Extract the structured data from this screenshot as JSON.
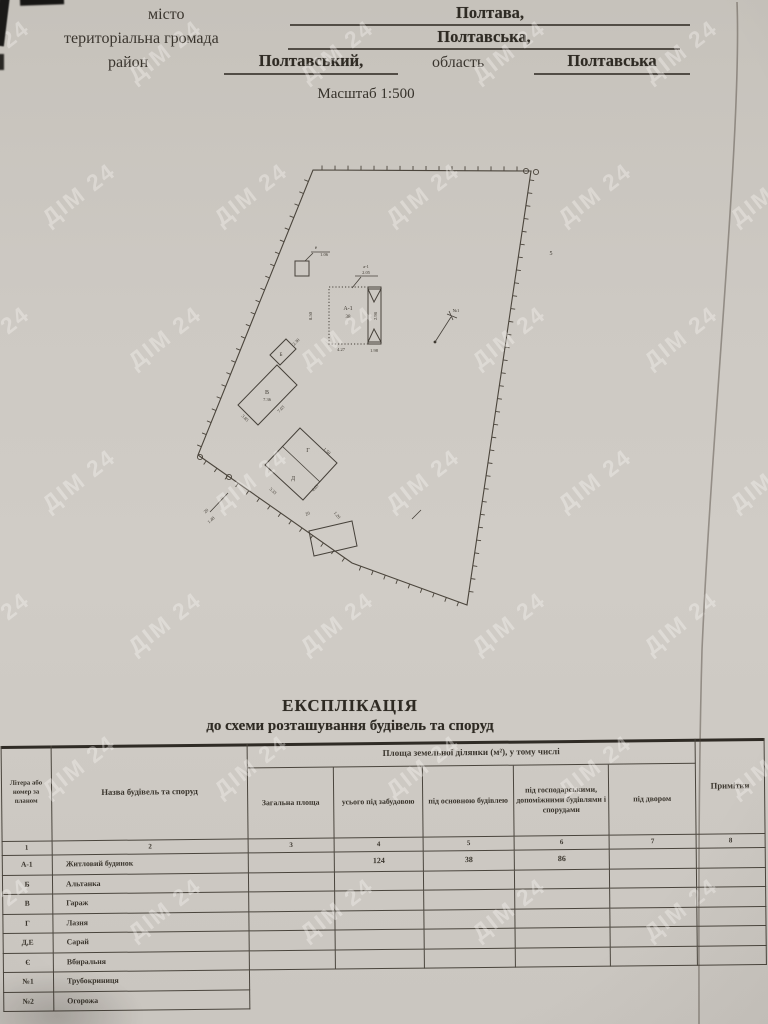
{
  "header": {
    "fields": [
      {
        "label": "місто",
        "value": "Полтава,"
      },
      {
        "label": "територіальна громада",
        "value": "Полтавська,"
      },
      {
        "label": "район",
        "value": "Полтавський,",
        "label2": "область",
        "value2": "Полтавська"
      }
    ],
    "scale": "Масштаб 1:500"
  },
  "watermark": {
    "text": "ДІМ 24"
  },
  "plan": {
    "boundary": [
      [
        313,
        170
      ],
      [
        531,
        171
      ],
      [
        467,
        605
      ],
      [
        352,
        563
      ],
      [
        198,
        455
      ]
    ],
    "circles": [
      [
        526,
        171
      ],
      [
        536,
        172
      ],
      [
        200,
        457
      ],
      [
        229,
        477
      ]
    ],
    "dots": [
      [
        435,
        342
      ]
    ],
    "shapes": [
      {
        "pts": [
          [
            329,
            287
          ],
          [
            368,
            287
          ],
          [
            368,
            344
          ],
          [
            329,
            344
          ]
        ],
        "dash": "1.2,2"
      },
      {
        "pts": [
          [
            368,
            287
          ],
          [
            381,
            287
          ],
          [
            381,
            344
          ],
          [
            368,
            344
          ]
        ]
      },
      {
        "pts": [
          [
            368,
            289
          ],
          [
            381,
            289
          ],
          [
            374,
            302
          ]
        ]
      },
      {
        "pts": [
          [
            368,
            342
          ],
          [
            381,
            342
          ],
          [
            374,
            329
          ]
        ]
      },
      {
        "pts": [
          [
            295,
            261
          ],
          [
            309,
            261
          ],
          [
            309,
            276
          ],
          [
            295,
            276
          ]
        ]
      },
      {
        "pts": [
          [
            270,
            355
          ],
          [
            286,
            339
          ],
          [
            296,
            349
          ],
          [
            280,
            365
          ]
        ]
      },
      {
        "pts": [
          [
            238,
            405
          ],
          [
            277,
            365
          ],
          [
            297,
            385
          ],
          [
            258,
            425
          ]
        ]
      },
      {
        "pts": [
          [
            300,
            428
          ],
          [
            337,
            463
          ],
          [
            303,
            500
          ],
          [
            265,
            465
          ]
        ]
      },
      {
        "pts": [
          [
            309,
            531
          ],
          [
            352,
            521
          ],
          [
            357,
            546
          ],
          [
            314,
            556
          ]
        ]
      }
    ],
    "lines": [
      [
        282,
        446,
        320,
        482
      ],
      [
        352,
        288,
        361,
        277
      ],
      [
        355,
        276,
        378,
        276
      ],
      [
        305,
        261,
        313,
        253
      ],
      [
        311,
        252,
        330,
        252
      ],
      [
        435,
        342,
        451,
        317
      ],
      [
        447,
        314,
        457,
        318
      ],
      [
        449,
        311,
        453,
        320
      ],
      [
        228,
        493,
        210,
        512
      ],
      [
        412,
        519,
        421,
        510
      ]
    ],
    "texts": [
      {
        "t": "А-1",
        "x": 348,
        "y": 310,
        "s": 6
      },
      {
        "t": "38",
        "x": 348,
        "y": 318,
        "s": 5
      },
      {
        "t": "8.50",
        "x": 312,
        "y": 316,
        "s": 4.5,
        "r": -90
      },
      {
        "t": "4.27",
        "x": 341,
        "y": 351,
        "s": 4.5
      },
      {
        "t": "1.98",
        "x": 374,
        "y": 352,
        "s": 4.5
      },
      {
        "t": "2.98",
        "x": 377,
        "y": 316,
        "s": 4.5,
        "r": -90
      },
      {
        "t": "а-1",
        "x": 366,
        "y": 268,
        "s": 4.5
      },
      {
        "t": "2.05",
        "x": 366,
        "y": 274,
        "s": 4.5
      },
      {
        "t": "е",
        "x": 316,
        "y": 249,
        "s": 5
      },
      {
        "t": "1.06",
        "x": 324,
        "y": 256,
        "s": 4.5
      },
      {
        "t": "Б",
        "x": 281,
        "y": 356,
        "s": 5
      },
      {
        "t": "2.30",
        "x": 297,
        "y": 343,
        "s": 4.5,
        "r": -45
      },
      {
        "t": "В",
        "x": 267,
        "y": 394,
        "s": 6
      },
      {
        "t": "7.36",
        "x": 267,
        "y": 401,
        "s": 4.5
      },
      {
        "t": "7.03",
        "x": 282,
        "y": 410,
        "s": 4.5,
        "r": -46
      },
      {
        "t": "3.85",
        "x": 244,
        "y": 419,
        "s": 4.5,
        "r": 45
      },
      {
        "t": "Г",
        "x": 308,
        "y": 452,
        "s": 6
      },
      {
        "t": "Д",
        "x": 293,
        "y": 480,
        "s": 6
      },
      {
        "t": "1.50",
        "x": 326,
        "y": 452,
        "s": 4.5,
        "r": 43
      },
      {
        "t": "3.33",
        "x": 272,
        "y": 492,
        "s": 4.5,
        "r": 42
      },
      {
        "t": "4.03",
        "x": 316,
        "y": 489,
        "s": 4.5,
        "r": -47
      },
      {
        "t": "20",
        "x": 207,
        "y": 512,
        "s": 4.5,
        "r": -42
      },
      {
        "t": "1.48",
        "x": 212,
        "y": 521,
        "s": 4.5,
        "r": -42
      },
      {
        "t": "20",
        "x": 308,
        "y": 515,
        "s": 4.5,
        "r": -20
      },
      {
        "t": "1.20",
        "x": 336,
        "y": 516,
        "s": 4.5,
        "r": 50
      },
      {
        "t": "№1",
        "x": 456,
        "y": 312,
        "s": 4.5
      },
      {
        "t": "5",
        "x": 551,
        "y": 255,
        "s": 6
      }
    ]
  },
  "explication": {
    "title": "ЕКСПЛІКАЦІЯ",
    "subtitle": "до схеми розташування будівель та споруд",
    "table": {
      "col1": "Літера або номер за планом",
      "col2": "Назва будівель та споруд",
      "area_group": "Площа земельної ділянки (м²), у тому числі",
      "subcols": [
        "Загальна площа",
        "усього під забудовою",
        "під основною будівлею",
        "під господарськими, допоміжними будівлями і спорудами",
        "під двором"
      ],
      "notes": "Примітки",
      "col_numbers": [
        "1",
        "2",
        "3",
        "4",
        "5",
        "6",
        "7",
        "8"
      ],
      "rows": [
        {
          "letter": "А-1",
          "name": "Житловий будинок",
          "values": [
            "",
            "124",
            "38",
            "86",
            "",
            ""
          ]
        },
        {
          "letter": "Б",
          "name": "Альтанка",
          "values": [
            "",
            "",
            "",
            "",
            "",
            ""
          ]
        },
        {
          "letter": "В",
          "name": "Гараж",
          "values": [
            "",
            "",
            "",
            "",
            "",
            ""
          ]
        },
        {
          "letter": "Г",
          "name": "Лазня",
          "values": [
            "",
            "",
            "",
            "",
            "",
            ""
          ]
        },
        {
          "letter": "Д,Е",
          "name": "Сарай",
          "values": [
            "",
            "",
            "",
            "",
            "",
            ""
          ]
        },
        {
          "letter": "Є",
          "name": "Вбиральня",
          "values": [
            "",
            "",
            "",
            "",
            "",
            ""
          ]
        },
        {
          "letter": "№1",
          "name": "Трубокриниця",
          "short": true
        },
        {
          "letter": "№2",
          "name": "Огорожа",
          "short": true
        }
      ]
    }
  }
}
